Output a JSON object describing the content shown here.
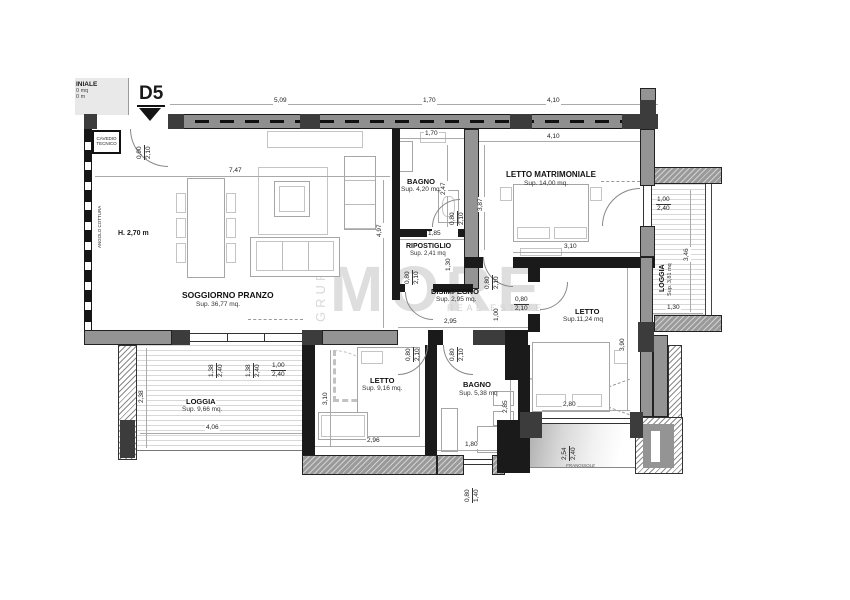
{
  "meta": {
    "unit": "D5"
  },
  "fragment": {
    "l1": "INIALE",
    "l2": "0 mq",
    "l3": "0 m"
  },
  "labels": {
    "cavedio1": "CAVEDIO",
    "cavedio2": "TECNICO",
    "angolo_cottura": "ANGOLO COTTURA",
    "height_note": "H. 2,70 m",
    "frangisole": "FRANGISOLE"
  },
  "watermark": {
    "side": "GRUPPO",
    "main": "MORE",
    "sub": "REAL ESTATE"
  },
  "rooms": {
    "soggiorno": {
      "name": "SOGGIORNO PRANZO",
      "area": "Sup. 36,77 mq."
    },
    "bagno1": {
      "name": "BAGNO",
      "area": "Sup. 4,20 mq"
    },
    "ripostiglio": {
      "name": "RIPOSTIGLIO",
      "area": "Sup. 2,41 mq"
    },
    "disimpegno": {
      "name": "DISIMPEGNO",
      "area": "Sup. 2,95 mq."
    },
    "letto_matrimoniale": {
      "name": "LETTO MATRIMONIALE",
      "area": "Sup. 14,00 mq."
    },
    "letto2": {
      "name": "LETTO",
      "area": "Sup.11,24 mq"
    },
    "letto3": {
      "name": "LETTO",
      "area": "Sup. 9,16 mq."
    },
    "bagno2": {
      "name": "BAGNO",
      "area": "Sup. 5,38 mq"
    },
    "loggia_left": {
      "name": "LOGGIA",
      "area": "Sup. 9,66 mq."
    },
    "loggia_right": {
      "name": "LOGGIA",
      "area": "Sup. 3,81 mq"
    }
  },
  "dims": {
    "d509": "5,09",
    "d170": "1,70",
    "d410": "4,10",
    "d747": "7,47",
    "d497": "4,97",
    "d247": "2,47",
    "d185": "1,85",
    "d130": "1,30",
    "d387": "3,87",
    "d310": "3,10",
    "d295": "2,95",
    "d100": "1,00",
    "d390": "3,90",
    "d280": "2,80",
    "d346": "3,46",
    "d296": "2,96",
    "d285": "2,85",
    "d180": "1,80",
    "d238": "2,38",
    "d406": "4,06"
  },
  "fracs": {
    "f090_210": {
      "top": "0,90",
      "bot": "2,10"
    },
    "f080_210": {
      "top": "0,80",
      "bot": "2,10"
    },
    "f138_240": {
      "top": "1,38",
      "bot": "2,40"
    },
    "f100_240": {
      "top": "1,00",
      "bot": "2,40"
    },
    "f080_140": {
      "top": "0,80",
      "bot": "1,40"
    },
    "f254_240": {
      "top": "2,54",
      "bot": "2,40"
    }
  }
}
